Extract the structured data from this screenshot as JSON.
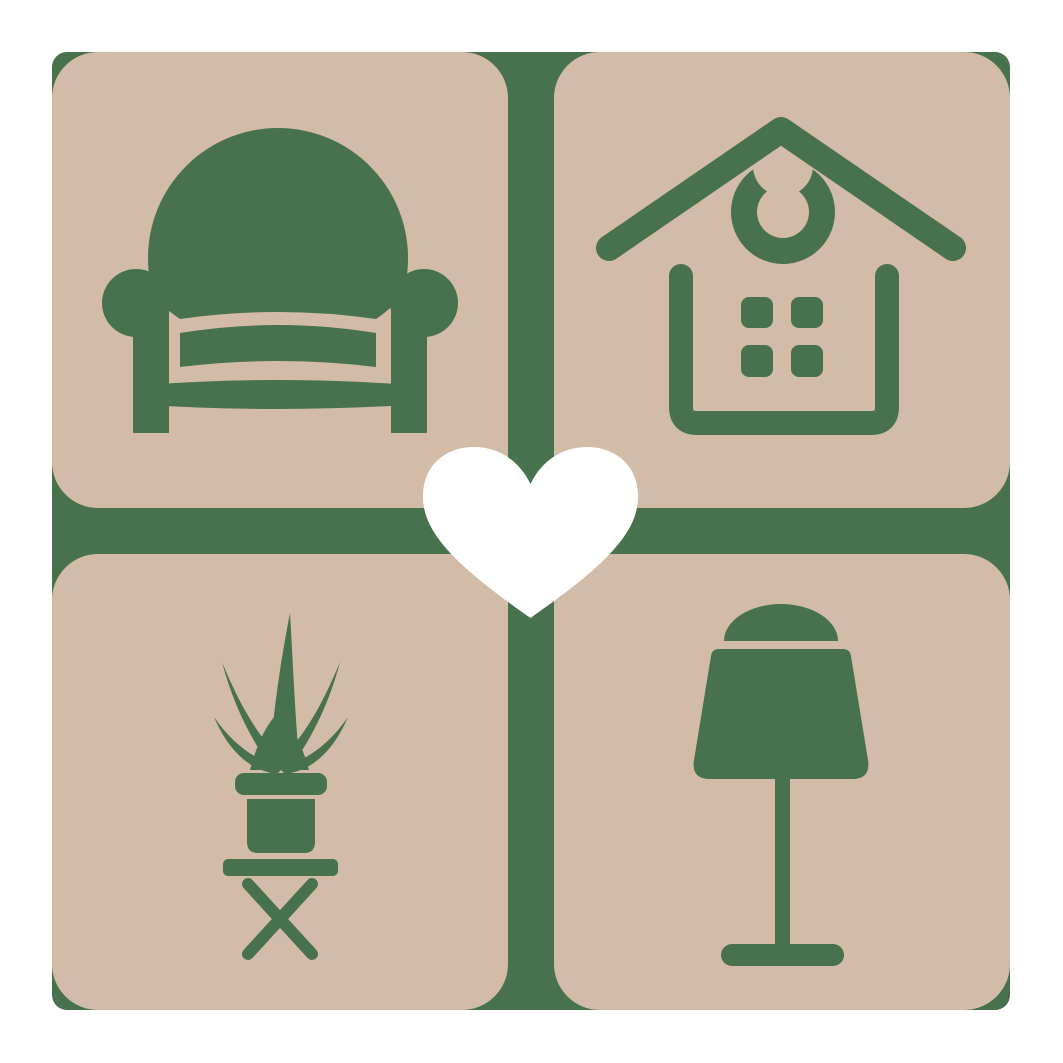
{
  "logo": {
    "description": "Home and furniture logo: four rounded square tiles in a 2x2 grid showing an armchair, a house, a potted plant on a stool and a table lamp, separated by a green cross divider with a white heart at the center",
    "tiles": [
      {
        "position": "top-left",
        "icon": "armchair-icon",
        "label": "armchair"
      },
      {
        "position": "top-right",
        "icon": "house-icon",
        "label": "house"
      },
      {
        "position": "bottom-left",
        "icon": "potted-plant-icon",
        "label": "potted plant on stool"
      },
      {
        "position": "bottom-right",
        "icon": "table-lamp-icon",
        "label": "table lamp"
      }
    ],
    "center_icon": "heart-icon"
  },
  "colors": {
    "page_background": "#ffffff",
    "tile": "#d3bca7",
    "green": "#48714e",
    "heart": "#ffffff"
  }
}
